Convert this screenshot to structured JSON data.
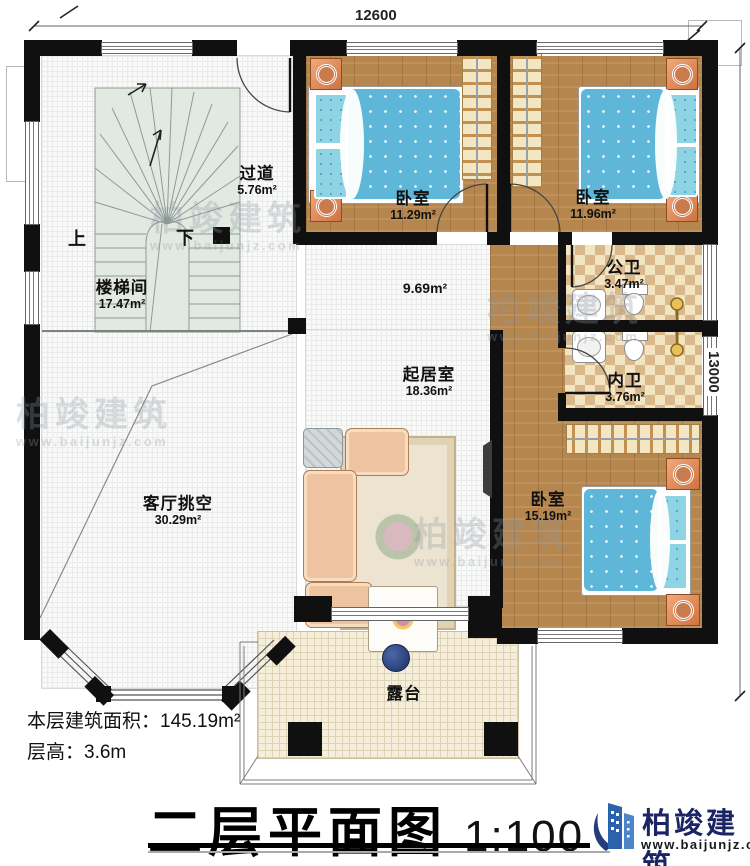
{
  "dimensions": {
    "top": "12600",
    "right": "13000"
  },
  "rooms": {
    "corridor": {
      "name": "过道",
      "area": "5.76m²"
    },
    "stairwell": {
      "name": "楼梯间",
      "area": "17.47m²"
    },
    "bedroom1": {
      "name": "卧室",
      "area": "11.29m²"
    },
    "bedroom2": {
      "name": "卧室",
      "area": "11.96m²"
    },
    "public_bath": {
      "name": "公卫",
      "area": "3.47m²"
    },
    "ensuite_bath": {
      "name": "内卫",
      "area": "3.76m²"
    },
    "hall": {
      "area": "9.69m²"
    },
    "living": {
      "name": "起居室",
      "area": "18.36m²"
    },
    "bedroom3": {
      "name": "卧室",
      "area": "15.19m²"
    },
    "void": {
      "name": "客厅挑空",
      "area": "30.29m²"
    },
    "terrace": {
      "name": "露台"
    }
  },
  "stairs": {
    "up": "上",
    "down": "下"
  },
  "footer": {
    "area_label": "本层建筑面积：",
    "area_value": "145.19m²",
    "height_label": "层高：",
    "height_value": "3.6m",
    "title": "二层平面图",
    "scale": "1:100"
  },
  "brand": {
    "name": "柏竣建筑",
    "website": "www.baijunjz.com"
  },
  "colors": {
    "wall": "#101010",
    "wood_floor": "#b6864f",
    "bed_blue": "#5eb7d9",
    "tile_tan": "#d9b98c",
    "brand_blue": "#1b2464",
    "stair_green": "#e2e9e3"
  }
}
